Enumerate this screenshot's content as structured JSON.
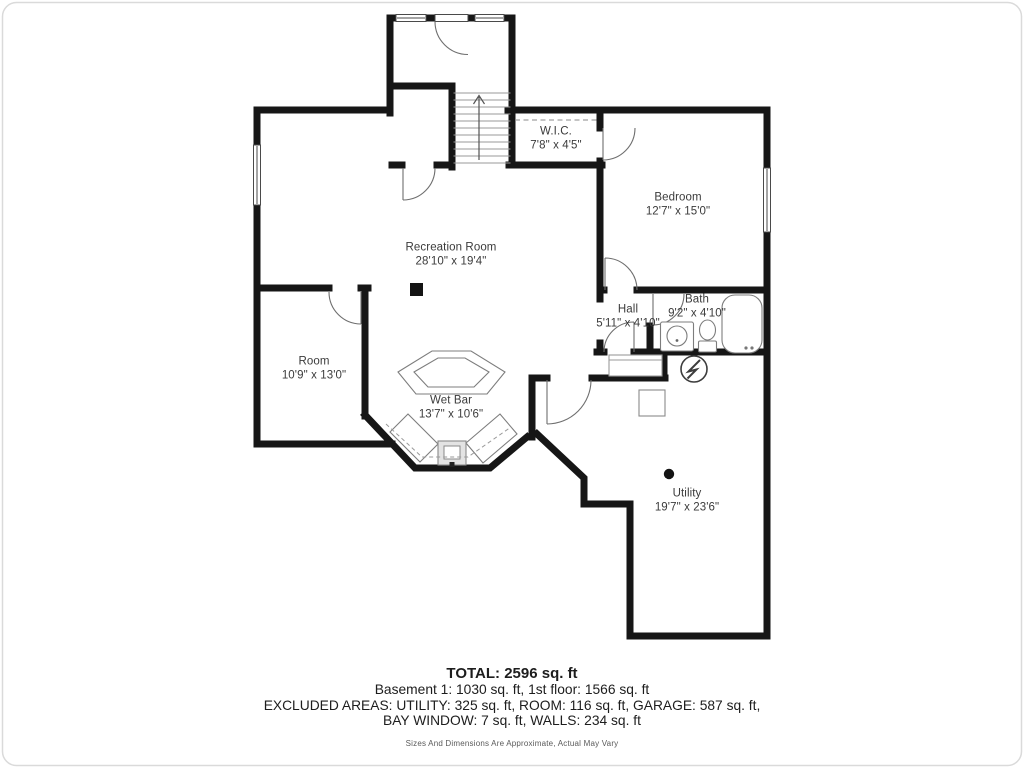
{
  "plan": {
    "rooms": [
      {
        "id": "wic",
        "name": "W.I.C.",
        "dims": "7'8\" x 4'5\"",
        "x": 556,
        "y": 139
      },
      {
        "id": "bedroom",
        "name": "Bedroom",
        "dims": "12'7\" x 15'0\"",
        "x": 678,
        "y": 205
      },
      {
        "id": "recreation",
        "name": "Recreation Room",
        "dims": "28'10\" x 19'4\"",
        "x": 451,
        "y": 255
      },
      {
        "id": "hall",
        "name": "Hall",
        "dims": "5'11\" x 4'10\"",
        "x": 628,
        "y": 317
      },
      {
        "id": "bath",
        "name": "Bath",
        "dims": "9'2\" x 4'10\"",
        "x": 697,
        "y": 307
      },
      {
        "id": "room",
        "name": "Room",
        "dims": "10'9\" x 13'0\"",
        "x": 314,
        "y": 369
      },
      {
        "id": "wetbar",
        "name": "Wet Bar",
        "dims": "13'7\" x 10'6\"",
        "x": 451,
        "y": 408
      },
      {
        "id": "utility",
        "name": "Utility",
        "dims": "19'7\" x 23'6\"",
        "x": 687,
        "y": 501
      }
    ]
  },
  "summary": {
    "total": "TOTAL: 2596 sq. ft",
    "line2": "Basement 1: 1030 sq. ft, 1st floor: 1566 sq. ft",
    "line3": "EXCLUDED AREAS: UTILITY: 325 sq. ft, ROOM: 116 sq. ft, GARAGE: 587 sq. ft,",
    "line4": "BAY WINDOW: 7 sq. ft, WALLS: 234 sq. ft",
    "disclaimer": "Sizes And Dimensions Are Approximate, Actual May Vary"
  },
  "colors": {
    "wall": "#161616",
    "fixture": "#7d7d7d",
    "text": "#3b3b3b"
  }
}
